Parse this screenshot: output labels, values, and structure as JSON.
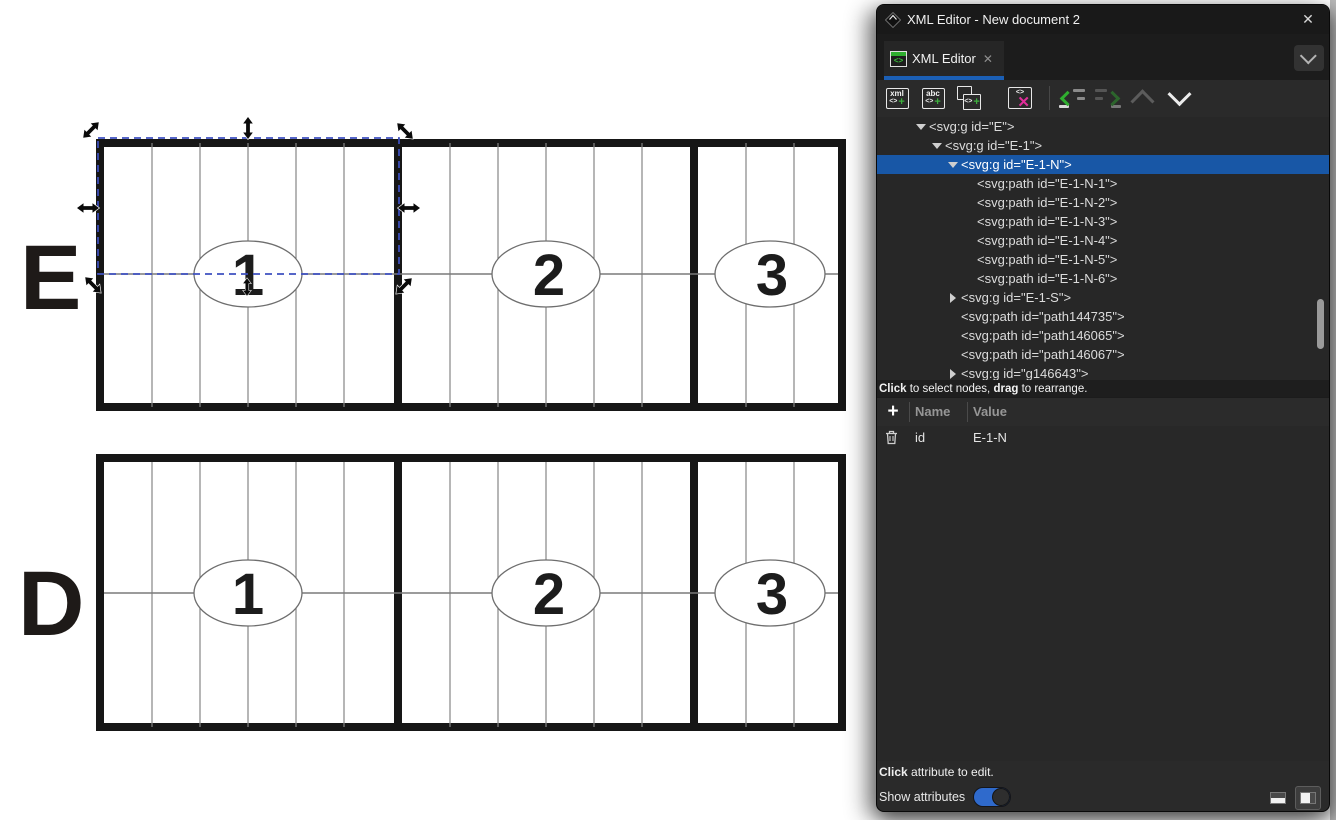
{
  "window": {
    "title": "XML Editor - New document 2",
    "close_glyph": "✕"
  },
  "tab": {
    "label": "XML Editor",
    "close_glyph": "✕",
    "icon_glyph": "<>"
  },
  "toolbar": {
    "new_element": {
      "line1": "xml",
      "brackets": "<>",
      "plus": "+"
    },
    "new_text": {
      "line1": "abc",
      "brackets": "<>",
      "plus": "+"
    },
    "duplicate": {
      "brackets": "<>",
      "plus": "+"
    },
    "delete": {
      "brackets": "<>",
      "x": "✕"
    }
  },
  "tree": {
    "items": [
      {
        "text": "<svg:g id=\"E\">"
      },
      {
        "text": "<svg:g id=\"E-1\">"
      },
      {
        "text": "<svg:g id=\"E-1-N\">"
      },
      {
        "text": "<svg:path id=\"E-1-N-1\">"
      },
      {
        "text": "<svg:path id=\"E-1-N-2\">"
      },
      {
        "text": "<svg:path id=\"E-1-N-3\">"
      },
      {
        "text": "<svg:path id=\"E-1-N-4\">"
      },
      {
        "text": "<svg:path id=\"E-1-N-5\">"
      },
      {
        "text": "<svg:path id=\"E-1-N-6\">"
      },
      {
        "text": "<svg:g id=\"E-1-S\">"
      },
      {
        "text": "<svg:path id=\"path144735\">"
      },
      {
        "text": "<svg:path id=\"path146065\">"
      },
      {
        "text": "<svg:path id=\"path146067\">"
      },
      {
        "text": "<svg:g id=\"g146643\">"
      }
    ],
    "selected_id": "E-1-N",
    "hint": {
      "bold1": "Click",
      "mid": " to select nodes, ",
      "bold2": "drag",
      "end": " to rearrange."
    }
  },
  "attributes": {
    "add_glyph": "+",
    "headers": {
      "name": "Name",
      "value": "Value"
    },
    "rows": [
      {
        "name": "id",
        "value": "E-1-N"
      }
    ]
  },
  "footer": {
    "hint_bold": "Click",
    "hint_rest": " attribute to edit.",
    "toggle_label": "Show attributes"
  },
  "canvas": {
    "rows": [
      {
        "letter": "E",
        "sections": [
          "1",
          "2",
          "3"
        ]
      },
      {
        "letter": "D",
        "sections": [
          "1",
          "2",
          "3"
        ]
      }
    ]
  },
  "colors": {
    "selection_row_blue": "#1857a6",
    "tab_accent_blue": "#1b5fb5",
    "toggle_blue": "#2f6acc",
    "icon_green": "#2fae2f",
    "icon_magenta": "#e12d9b",
    "canvas_selection_blue": "#3f51c1"
  }
}
